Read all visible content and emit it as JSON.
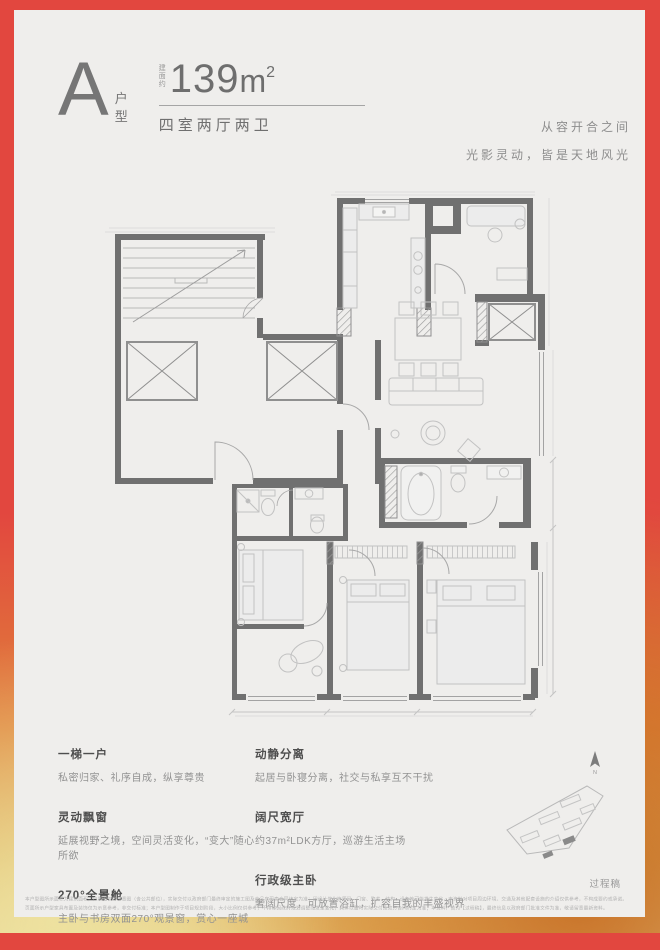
{
  "header": {
    "type_letter": "A",
    "type_label_1": "户",
    "type_label_2": "型",
    "area_prefix": "建面约",
    "area_value": "139",
    "area_unit": "m",
    "area_sup": "2",
    "rooms": "四室两厅两卫",
    "slogan_line1": "从容开合之间",
    "slogan_line2": "光影灵动，皆是天地风光"
  },
  "features": {
    "left": [
      {
        "title": "一梯一户",
        "desc": "私密归家、礼序自成，纵享尊贵"
      },
      {
        "title": "灵动飘窗",
        "desc": "延展视野之境，空间灵活变化，“变大”随心所欲"
      },
      {
        "title": "270°全景舱",
        "desc": "主卧与书房双面270°观景窗，赏心一座城"
      }
    ],
    "right": [
      {
        "title": "动静分离",
        "desc": "起居与卧寝分离，社交与私享互不干扰"
      },
      {
        "title": "阔尺宽厅",
        "desc": "约37m²LDK方厅，巡游生活主场"
      },
      {
        "title": "行政级主卧",
        "desc": "奢阔尺度，可放置浴缸，扩容自我的丰盛视界"
      }
    ]
  },
  "footer": {
    "watermark": "过程稿",
    "compass_label": "N",
    "disclaimer_line1": "本户型图所示面积为建筑面积，户型图仅为示意图（含公共部位），实际交付以政府部门最终审定的施工图及商品房买卖合同约定为准；因设计优化等原因，门窗、管井、结构、设备等可能发生变化，本资料对项目周边环境、交通及其他配套设施的介绍仅供参考，不构成要约或承诺。",
    "disclaimer_line2": "页面所示户型家具布置及装饰仅为示意参考，非交付标准；本户型图制作于项目规划阶段，大小比例仅供参考，不排除因政府规划调整而发生变化，具体以届时实际交付及双方合同约定为准；本资料广告为【过程稿】，最终信息以政府部门批准文件为准，敬请留意最新资料。"
  },
  "colors": {
    "border_red": "#e2473f",
    "border_orange": "#e0823a",
    "border_yellow": "#e7d492",
    "card_bg": "#efeeec",
    "wall": "#707070",
    "furniture": "#c2c2c2"
  }
}
